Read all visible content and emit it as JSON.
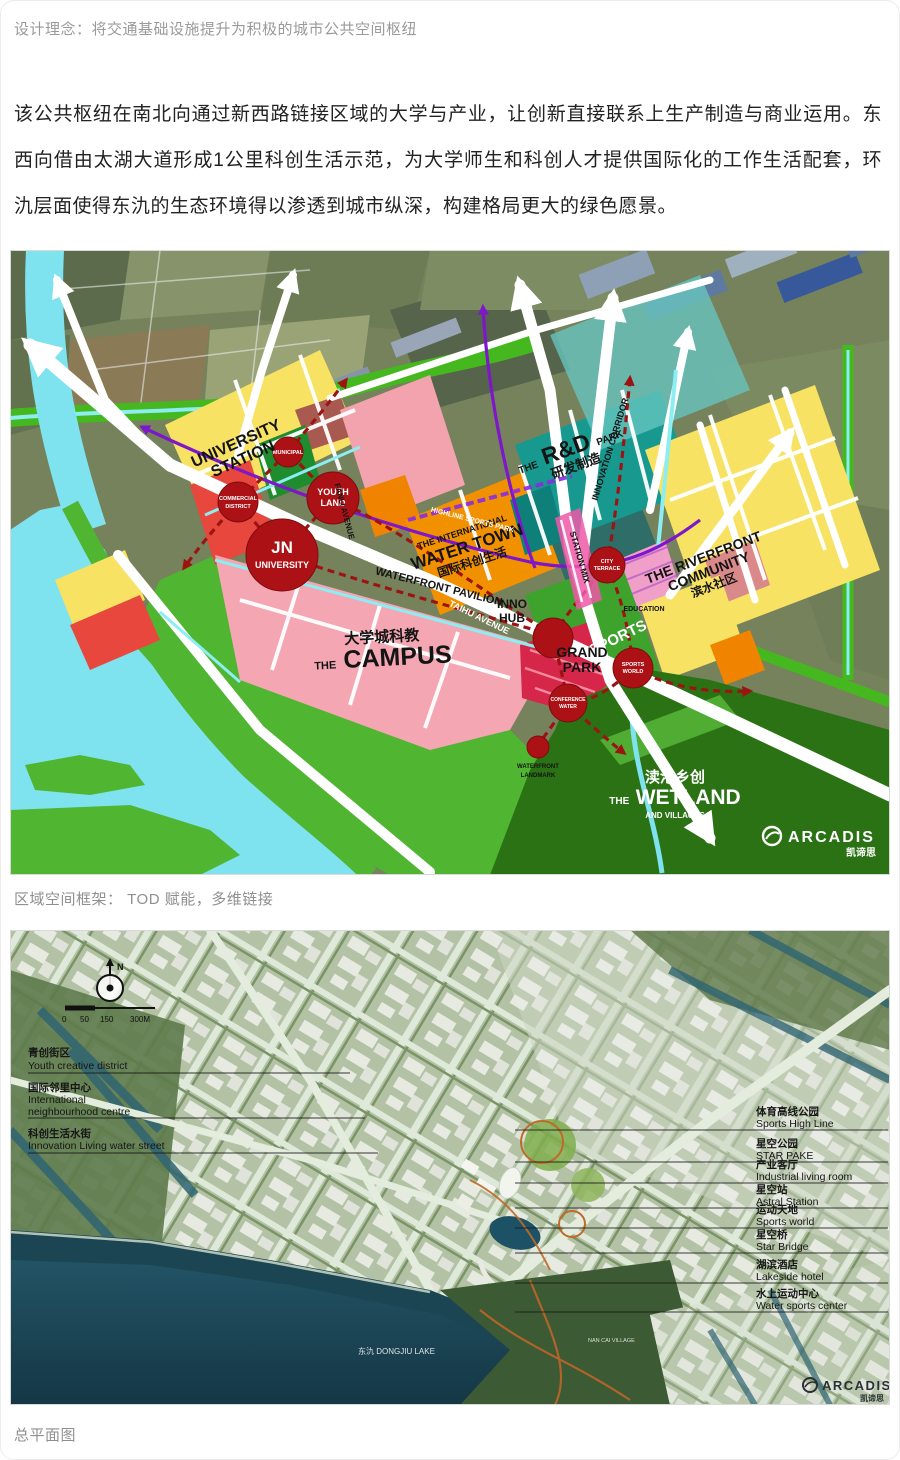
{
  "page": {
    "subtitle": "设计理念：将交通基础设施提升为积极的城市公共空间枢纽",
    "paragraph": "该公共枢纽在南北向通过新西路链接区域的大学与产业，让创新直接联系上生产制造与商业运用。东西向借由太湖大道形成1公里科创生活示范，为大学师生和科创人才提供国际化的工作生活配套，环氿层面使得东氿的生态环境得以渗透到城市纵深，构建格局更大的绿色愿景。",
    "caption_framework": "区域空间框架： TOD 赋能，多维链接",
    "caption_masterplan": "总平面图"
  },
  "palette": {
    "water_cyan": "#7fe3ef",
    "park_green": "#50b531",
    "wetland_green": "#2a7214",
    "campus_pink": "#f4a6b2",
    "commercial_red": "#e8473e",
    "node_red": "#ab1115",
    "zone_yellow": "#f7e263",
    "zone_orange": "#f29100",
    "rd_teal": "#17998f",
    "rd_teal_light": "#66c5c0",
    "metro_purple": "#7d17c9",
    "dash_red": "#9c1412",
    "plan_water": "#1c4553",
    "plan_base": "#b3c2a4"
  },
  "map1": {
    "labels": {
      "university_station": [
        "UNIVERSITY",
        "STATION"
      ],
      "municipal": "MUNICIPAL",
      "commercial_district": [
        "COMMERCIAL",
        "DISTRICT"
      ],
      "youth_land": [
        "YOUTH",
        "LAND"
      ],
      "jn_university": [
        "JN",
        "UNIVERSITY"
      ],
      "fanli_avenue": "FANLI AVENUE",
      "taihu_avenue": "TAIHU AVENUE",
      "waterfront_pavilion": "WATERFRONT PAVILION",
      "water_town": [
        "THE INTERNATIONAL",
        "WATER TOWN",
        "国际科创生活"
      ],
      "highline": "HIGHLINE SPORTS PARK",
      "rd_the": "THE",
      "rd_main": "R&D",
      "rd_park": "PARK",
      "rd_cn": "研发制造",
      "innovation_corridor": "INNOVATION CORRIDOR",
      "riverfront": [
        "THE RIVERFRONT",
        "COMMUNITY",
        "滨水社区"
      ],
      "campus_cn": "大学城科教",
      "campus_the": "THE",
      "campus_main": "CAMPUS",
      "inno_hub": [
        "INNO",
        "HUB"
      ],
      "station_mix": "STATION MIX",
      "sports": "SPORTS",
      "education": "EDUCATION",
      "grand_park": [
        "GRAND",
        "PARK"
      ],
      "city_terrace": [
        "CITY",
        "TERRACE"
      ],
      "sports_world": [
        "SPORTS",
        "WORLD"
      ],
      "conference_water": [
        "CONFERENCE",
        "WATER"
      ],
      "waterfront_landmark": [
        "WATERFRONT",
        "LANDMARK"
      ],
      "wetland_cn": "渎港乡创",
      "wetland_the": "THE",
      "wetland_main": "WETLAND",
      "wetland_sub": "AND VILLAGES"
    },
    "logo_name": "ARCADIS",
    "logo_cn": "凯谛思"
  },
  "map2": {
    "north_label": "N",
    "scale_ticks": [
      "0",
      "50",
      "150",
      "300M"
    ],
    "left_labels": [
      {
        "cn": "青创街区",
        "en1": "Youth creative district",
        "en2": ""
      },
      {
        "cn": "国际邻里中心",
        "en1": "International",
        "en2": "neighbourhood centre"
      },
      {
        "cn": "科创生活水街",
        "en1": "Innovation Living water street",
        "en2": ""
      }
    ],
    "right_labels": [
      {
        "cn": "体育高线公园",
        "en": "Sports High Line"
      },
      {
        "cn": "星空公园",
        "en": "STAR PAKE"
      },
      {
        "cn": "产业客厅",
        "en": "Industrial living room"
      },
      {
        "cn": "星空站",
        "en": "Astral Station"
      },
      {
        "cn": "运动天地",
        "en": "Sports world"
      },
      {
        "cn": "星空桥",
        "en": "Star Bridge"
      },
      {
        "cn": "湖滨酒店",
        "en": "Lakeside hotel"
      },
      {
        "cn": "水上运动中心",
        "en": "Water sports center"
      }
    ],
    "lake_label": "东氿 DONGJIU LAKE",
    "village_label": "NAN CAI VILLAGE",
    "logo_name": "ARCADIS",
    "logo_cn": "凯谛思"
  }
}
